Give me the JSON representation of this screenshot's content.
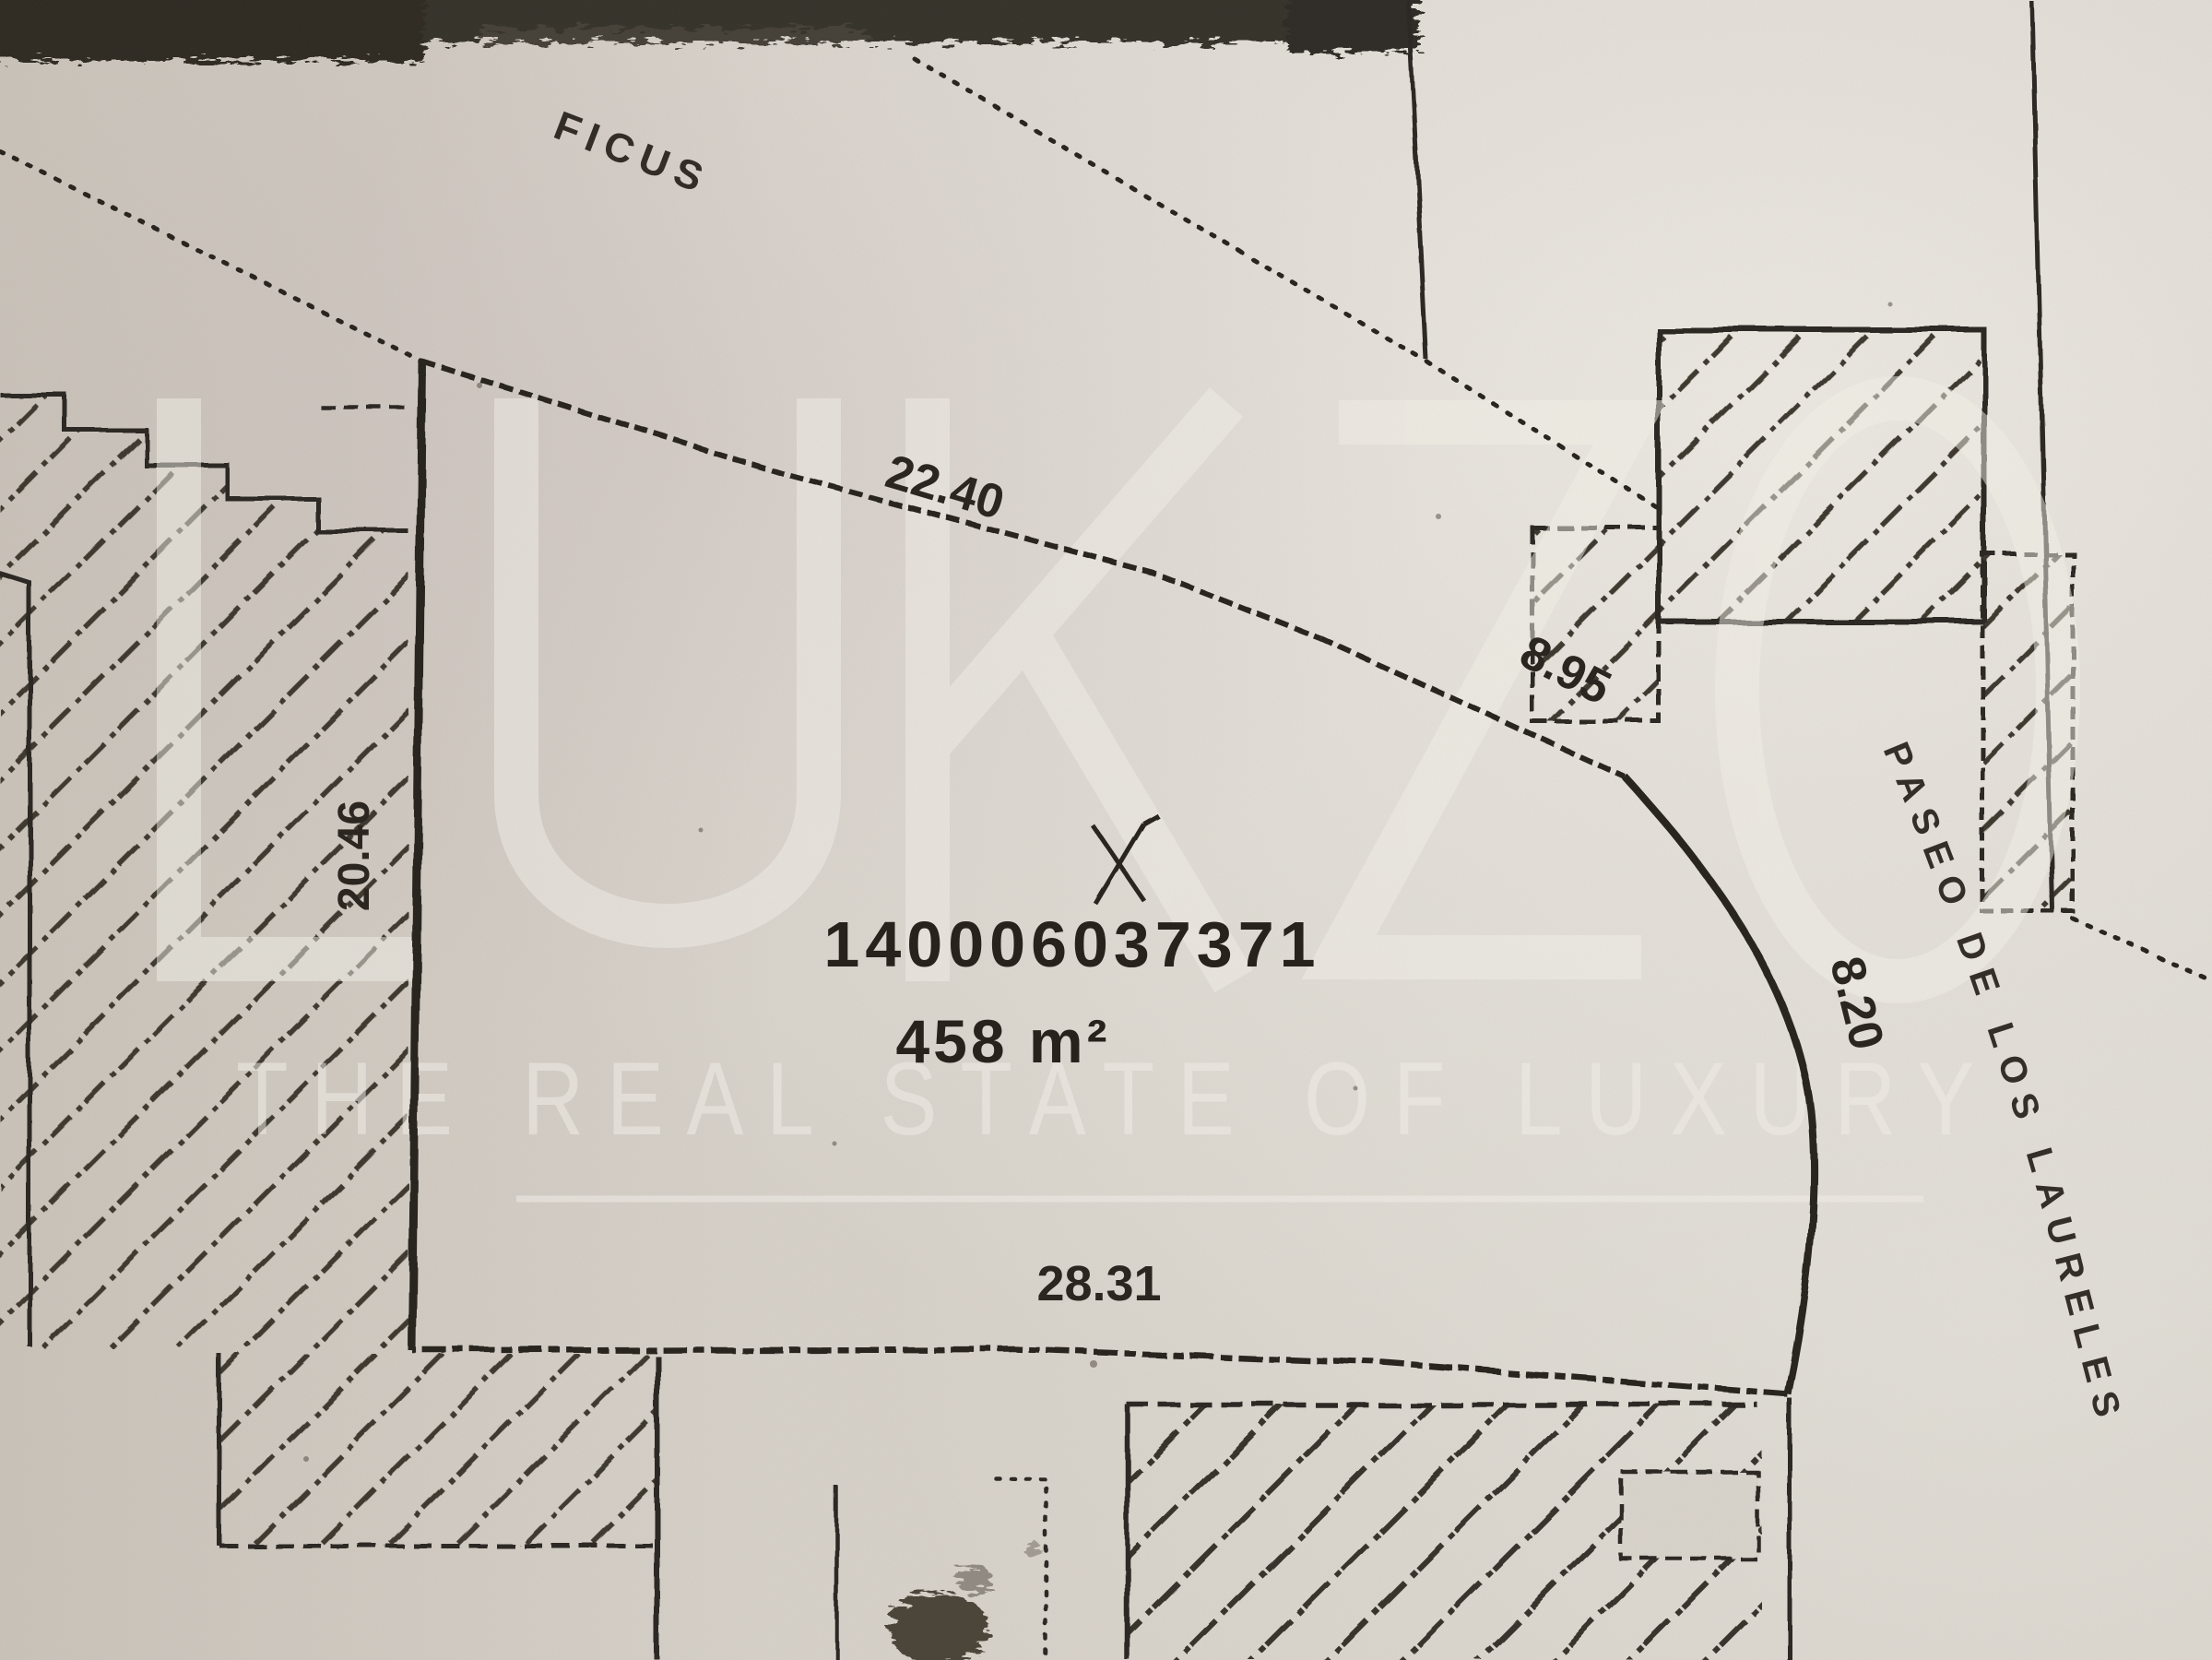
{
  "document": {
    "kind": "scanned cadastral site plan",
    "parcel": {
      "id": "140006037371",
      "area_label": "458 m²",
      "sides": {
        "top": "22.40",
        "upper_right": "8.95",
        "right_curve": "8.20",
        "left": "20.46",
        "bottom": "28.31"
      }
    },
    "street_label": "PASEO DE LOS LAURELES",
    "vegetation_label": "FICUS",
    "watermark": {
      "brand": "LUKZO",
      "tagline": "THE REAL STATE OF LUXURY"
    },
    "colors": {
      "paper": "#d7d2ca",
      "paper-light": "#ece9e2",
      "ink": "#28231d",
      "hatch": "#3d372f",
      "strip": "#34302a",
      "watermark": "#f4f1ea"
    }
  }
}
